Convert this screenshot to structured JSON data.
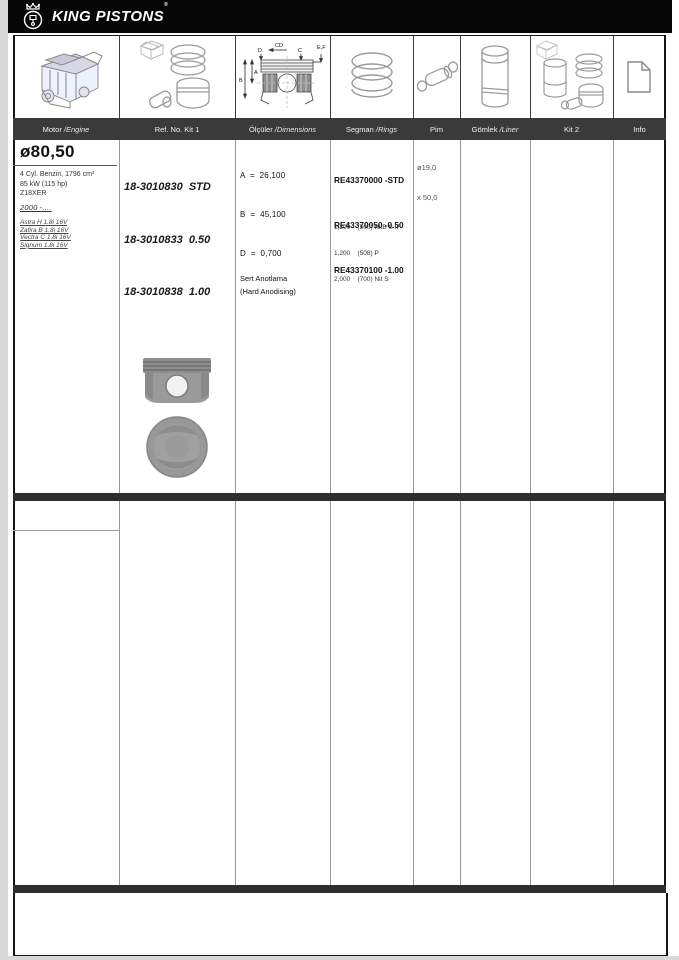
{
  "brand": {
    "name": "KING PISTONS",
    "mark": "®"
  },
  "header": {
    "columns": [
      {
        "label": "Motor ",
        "italic": "/Engine"
      },
      {
        "label": "Ref. No. Kit 1",
        "italic": ""
      },
      {
        "label": "Ölçüler ",
        "italic": "/Dimensions"
      },
      {
        "label": "Segman ",
        "italic": "/Rings"
      },
      {
        "label": "Pim",
        "italic": ""
      },
      {
        "label": "Gömlek ",
        "italic": "/Liner"
      },
      {
        "label": "Kit 2",
        "italic": ""
      },
      {
        "label": "Info",
        "italic": ""
      }
    ]
  },
  "part": {
    "bore": "ø80,50",
    "engine_lines": [
      "4 Cyl. Benzin, 1796 cm³",
      "85 kW (115 hp)",
      "Z18XER"
    ],
    "years": "2000 -....",
    "vehicles": [
      "Astra H 1.8i 16V",
      "Zafira B 1.8i 16V",
      "Vectra C 1.8i 16V",
      "Signum 1.8i 16V"
    ],
    "kit1_refs": [
      "18-3010830  STD",
      "18-3010833  0.50",
      "18-3010838  1.00"
    ],
    "dimensions": [
      "A  =  26,100",
      "B  =  45,100",
      "D  =  0,700"
    ],
    "coating": [
      "Sert Anotlama",
      "(Hard Anodising)"
    ],
    "ring_refs": [
      "RE43370000 -STD",
      "RE43370050 -0.50",
      "RE43370100 -1.00"
    ],
    "ring_details": [
      "1,200    (500) NitB S IF",
      "1,200    (508) P",
      "2,000    (700) Nit S"
    ],
    "pin": [
      "ø19,0",
      "x 50,0"
    ]
  },
  "diagram_labels": {
    "d": "D",
    "cd": "CD",
    "c": "C",
    "ef": "E,F",
    "a": "A",
    "b": "B"
  },
  "colors": {
    "accent_dark": "#2d2d2d",
    "header_bg": "#3a3a3a",
    "logo_bg": "#060606",
    "piston_gray": "#949494"
  }
}
